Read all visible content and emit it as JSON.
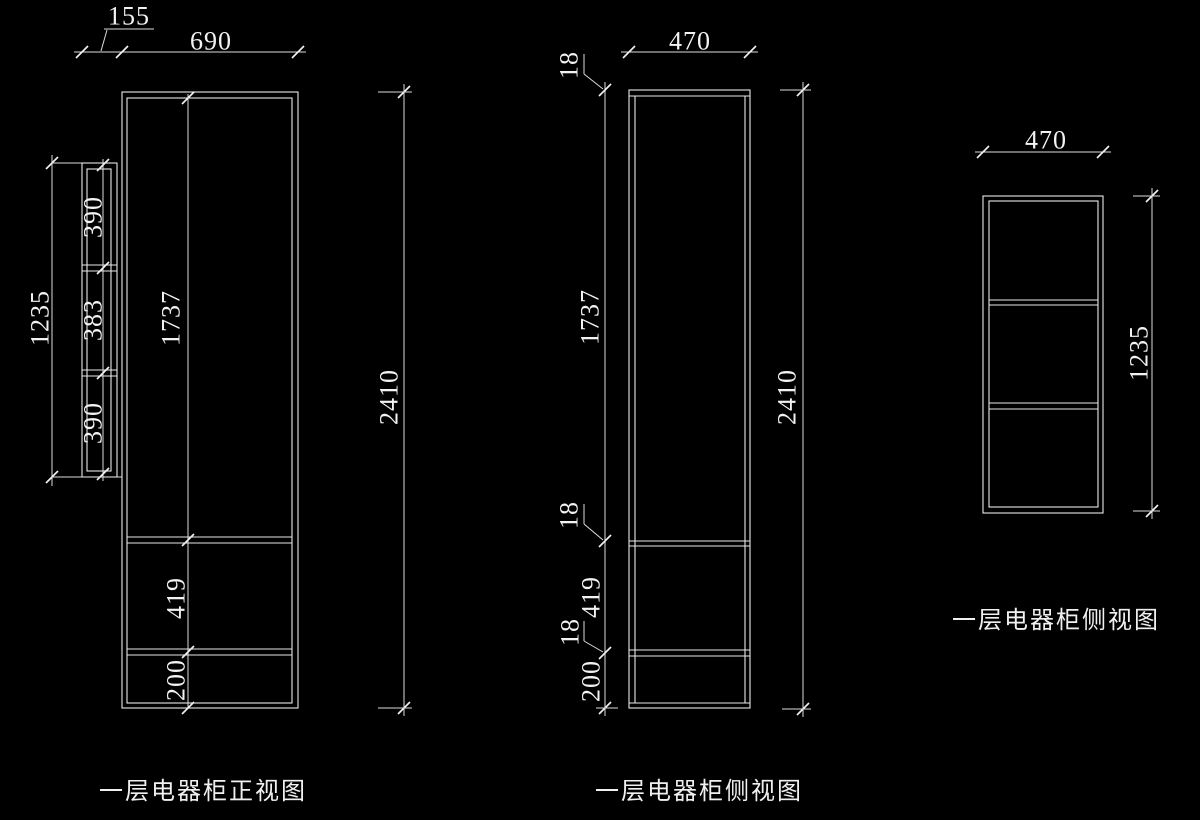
{
  "canvas": {
    "background": "#000000",
    "line_color": "#e9e9e9",
    "text_color": "#f2f2f2"
  },
  "front_view": {
    "label": "一层电器柜正视图",
    "dims": {
      "side_offset": "155",
      "width": "690",
      "side_panel_height": "1235",
      "side_seg_top": "390",
      "side_seg_middle": "383",
      "side_seg_bottom": "390",
      "door_height": "1737",
      "drawer_height": "419",
      "base_height": "200",
      "total_height": "2410"
    }
  },
  "side_view": {
    "label": "一层电器柜侧视图",
    "dims": {
      "width": "470",
      "top_panel_thickness": "18",
      "door_height": "1737",
      "shelf_thickness_upper": "18",
      "drawer_height": "419",
      "shelf_thickness_lower": "18",
      "base_height": "200",
      "total_height": "2410"
    }
  },
  "upper_cabinet_side_view": {
    "label": "一层电器柜侧视图",
    "dims": {
      "width": "470",
      "height": "1235"
    }
  }
}
